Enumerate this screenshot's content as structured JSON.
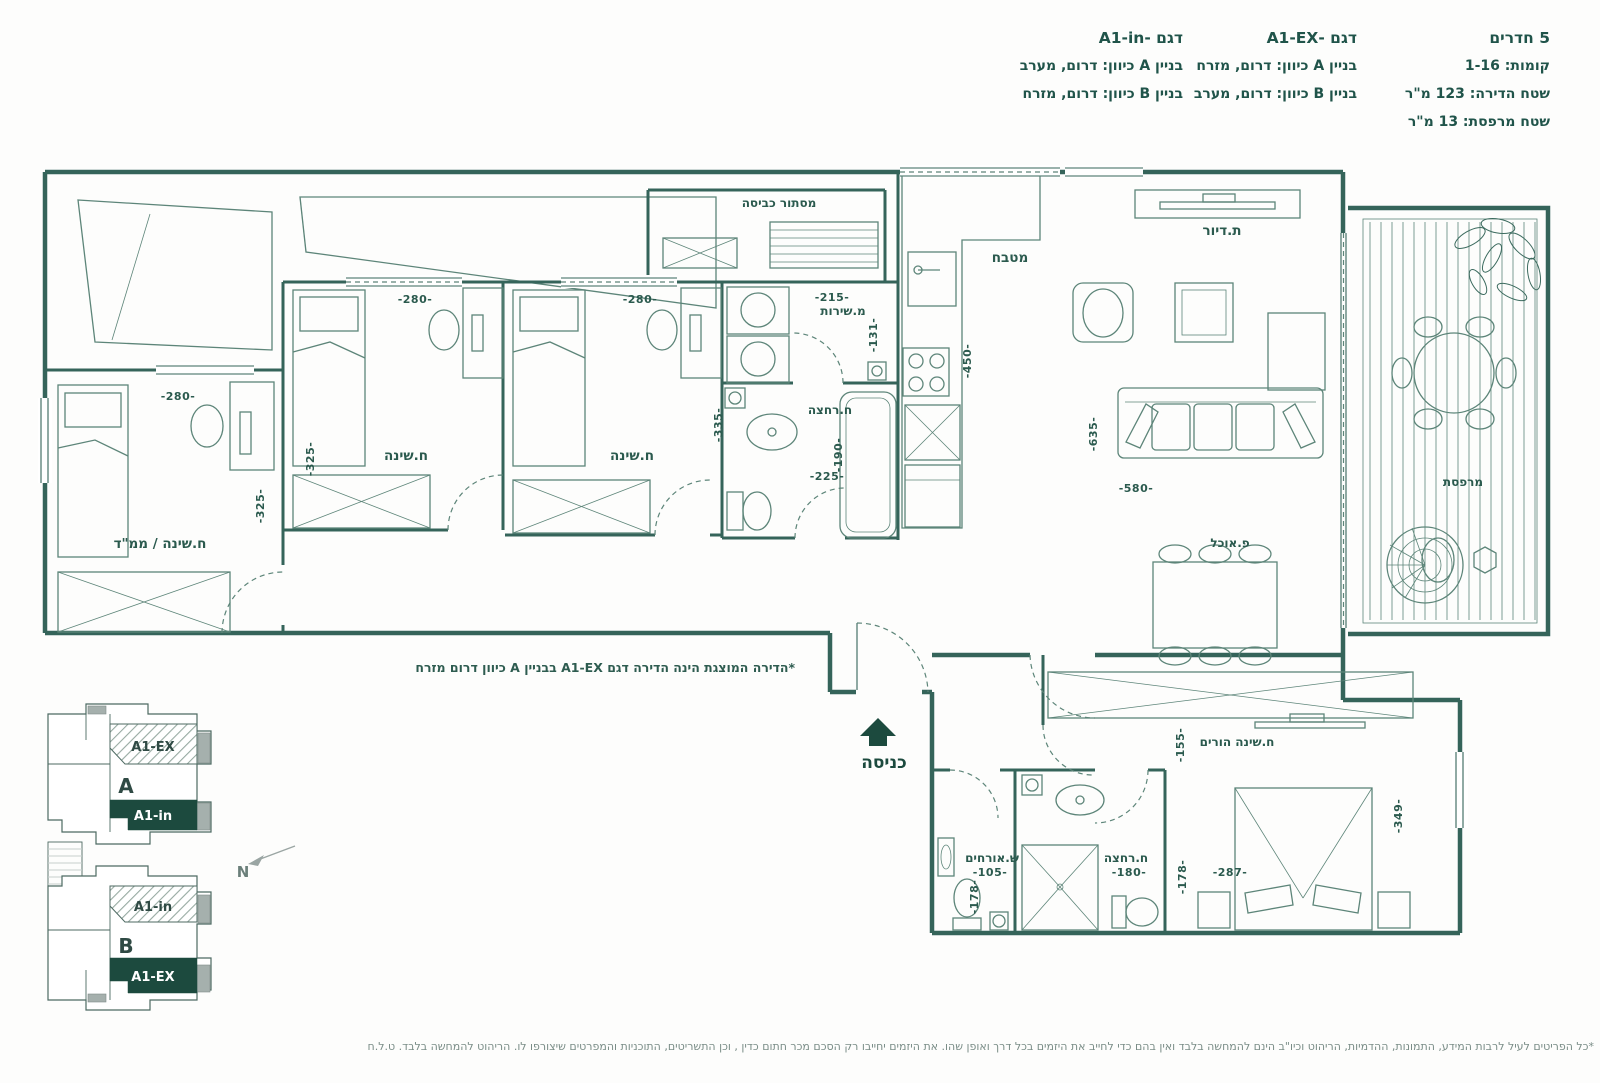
{
  "header": {
    "unit": {
      "rooms": "5 חדרים",
      "floors": "קומות: 1-16",
      "area": "שטח הדירה: 123 מ\"ר",
      "balcony": "שטח מרפסת: 13 מ\"ר"
    },
    "model_ex": {
      "title": "דגם -A1-EX",
      "building_a": "בניין A כיוון: דרום, מזרח",
      "building_b": "בניין B כיוון: דרום, מערב"
    },
    "model_in": {
      "title": "דגם -A1-in",
      "building_a": "בניין A כיוון: דרום, מערב",
      "building_b": "בניין B כיוון: דרום, מזרח"
    }
  },
  "plan": {
    "rooms": {
      "laundry": "מסתור כביסה",
      "mamad": "ח.שינה / ממ\"ד",
      "bedroom2": "ח.שינה",
      "bedroom3": "ח.שינה",
      "service_wc": "מ.שירות",
      "bath_upper": "ח.רחצה",
      "kitchen": "מטבח",
      "living": "ת.דיור",
      "dining": "פ.אוכל",
      "balcony": "מרפסת",
      "master": "ח.שינה הורים",
      "guest_wc": "ש.אורחים",
      "bath_lower": "ח.רחצה"
    },
    "dims": {
      "mamad_w": "-280-",
      "mamad_h": "-325-",
      "bed2_w": "-280-",
      "bed2_h": "-325-",
      "bed3_w": "-280-",
      "bed3_h": "-335-",
      "service_w": "-215-",
      "service_h": "-131-",
      "bath_upper_h": "-190-",
      "bath_upper_w": "-225-",
      "kitchen_h": "-450-",
      "living_h": "-635-",
      "living_w": "-580-",
      "master_h1": "-155-",
      "master_w": "-287-",
      "master_h2": "-349-",
      "guest_w": "-105-",
      "guest_h": "-178-",
      "bath_lower_w": "-180-",
      "bath_lower_h": "-178-"
    },
    "entrance_label": "כניסה",
    "annotation": "*הדירה המוצגת הינה הדירה דגם A1-EX בבניין A כיוון דרום מזרח"
  },
  "keyplan": {
    "building_a": "A",
    "building_b": "B",
    "unit_ex": "A1-EX",
    "unit_in": "A1-in",
    "north": "N"
  },
  "footer": {
    "disclaimer": "*כל הפריטים לעיל לרבות המידע, התמונות, ההדמיות, הריהוט וכיו\"ב הינם להמחשה בלבד ואין בהם כדי לחייב את היזמים בכל דרך ואופן שהו. את היזמים יחייבו רק הסכם מכר חתום כדין , וכן התשריטים, התוכניות והמפרטים שיצורפו לו. הריהוט להמחשה בלבד. ט.ל.ח"
  }
}
